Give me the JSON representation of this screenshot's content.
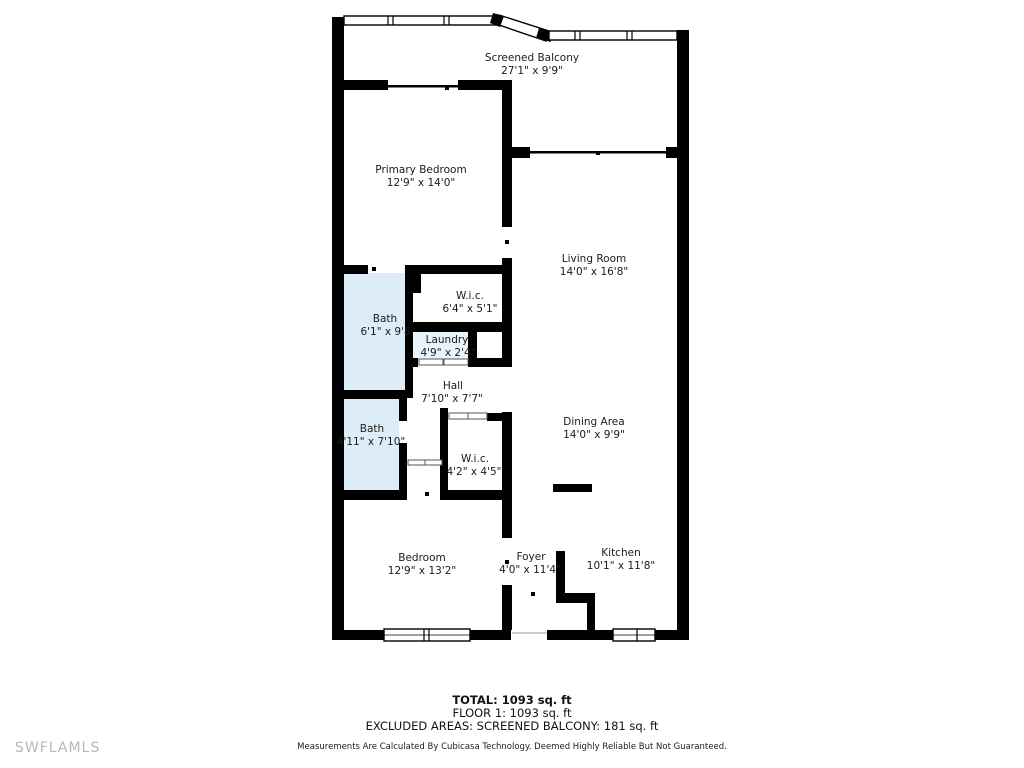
{
  "colors": {
    "wall": "#000000",
    "bath_fill": "#dcedf8",
    "laundry_fill": "#e9f3fa",
    "label_text": "#1b1b1b",
    "watermark": "#b8b8b8"
  },
  "rooms": [
    {
      "name": "Screened Balcony",
      "dims": "27'1\" x 9'9\""
    },
    {
      "name": "Primary Bedroom",
      "dims": "12'9\" x 14'0\""
    },
    {
      "name": "Living Room",
      "dims": "14'0\" x 16'8\""
    },
    {
      "name": "W.i.c.",
      "dims": "6'4\" x 5'1\""
    },
    {
      "name": "Bath",
      "dims": "6'1\" x 9'8\""
    },
    {
      "name": "Laundry",
      "dims": "4'9\" x 2'4\""
    },
    {
      "name": "Hall",
      "dims": "7'10\" x 7'7\""
    },
    {
      "name": "Bath",
      "dims": "4'11\" x 7'10\""
    },
    {
      "name": "Dining Area",
      "dims": "14'0\" x 9'9\""
    },
    {
      "name": "W.i.c.",
      "dims": "4'2\" x 4'5\""
    },
    {
      "name": "Bedroom",
      "dims": "12'9\" x 13'2\""
    },
    {
      "name": "Foyer",
      "dims": "4'0\" x 11'4\""
    },
    {
      "name": "Kitchen",
      "dims": "10'1\" x 11'8\""
    }
  ],
  "summary": {
    "total": "TOTAL: 1093 sq. ft",
    "floor": "FLOOR 1: 1093 sq. ft",
    "excluded": "EXCLUDED AREAS: SCREENED BALCONY: 181 sq. ft",
    "disclaimer": "Measurements Are Calculated By Cubicasa Technology. Deemed Highly Reliable But Not Guaranteed."
  },
  "watermark": "SWFLAMLS"
}
